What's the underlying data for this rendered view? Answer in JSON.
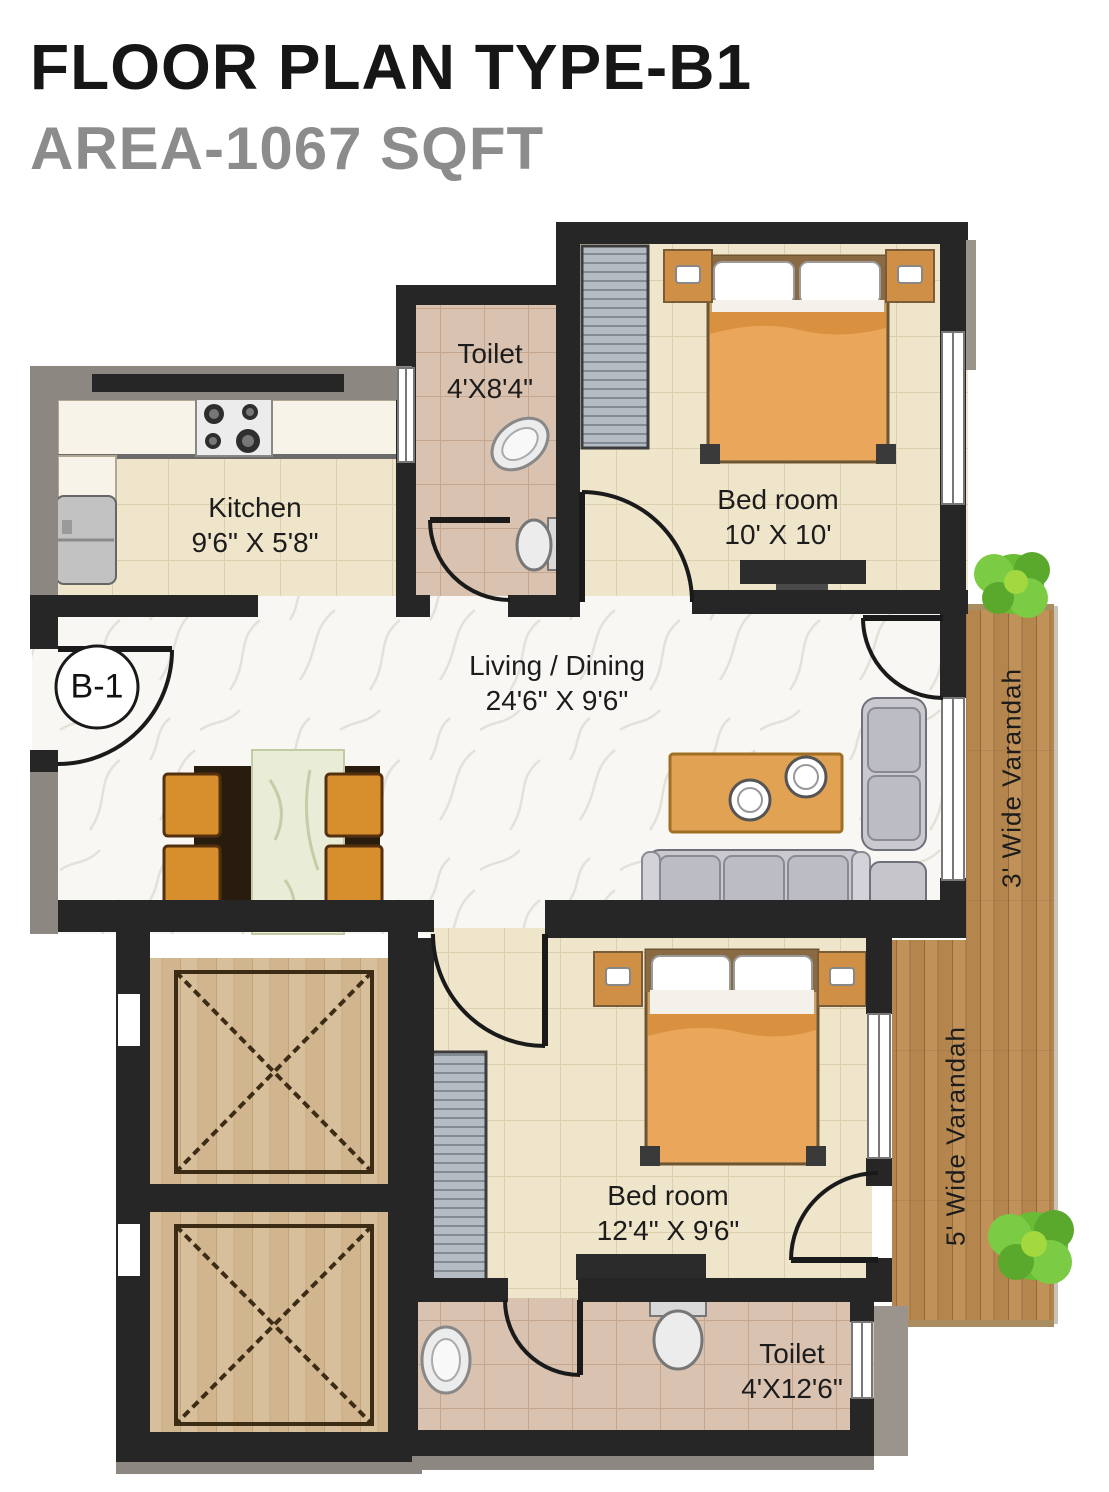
{
  "header": {
    "title": "FLOOR PLAN TYPE-B1",
    "subtitle": "AREA-1067 SQFT"
  },
  "unit": {
    "badge": "B-1"
  },
  "rooms": {
    "toilet_top": {
      "name": "Toilet",
      "dims": "4'X8'4\""
    },
    "kitchen": {
      "name": "Kitchen",
      "dims": "9'6\" X 5'8\""
    },
    "bedroom_top": {
      "name": "Bed room",
      "dims": "10' X 10'"
    },
    "living": {
      "name": "Living / Dining",
      "dims": "24'6\" X 9'6\""
    },
    "bedroom_bottom": {
      "name": "Bed room",
      "dims": "12'4\" X 9'6\""
    },
    "toilet_bottom": {
      "name": "Toilet",
      "dims": "4'X12'6\""
    },
    "varandah_3": {
      "name": "3' Wide Varandah"
    },
    "varandah_5": {
      "name": "5' Wide Varandah"
    }
  },
  "colors": {
    "wall_dark": "#262626",
    "wall_gray": "#8d8781",
    "floor_tile": "#efe5cb",
    "floor_toilet": "#d9c2b0",
    "floor_marble": "#f8f7f4",
    "varandah_wood": "#c09158",
    "lift_wood": "#d8bf9b",
    "blanket_orange": "#eaa75c",
    "sofa_gray": "#c9c9cf",
    "table_orange": "#e2a253",
    "chair_orange": "#d78f2e",
    "bush_green": "#69bd34"
  }
}
